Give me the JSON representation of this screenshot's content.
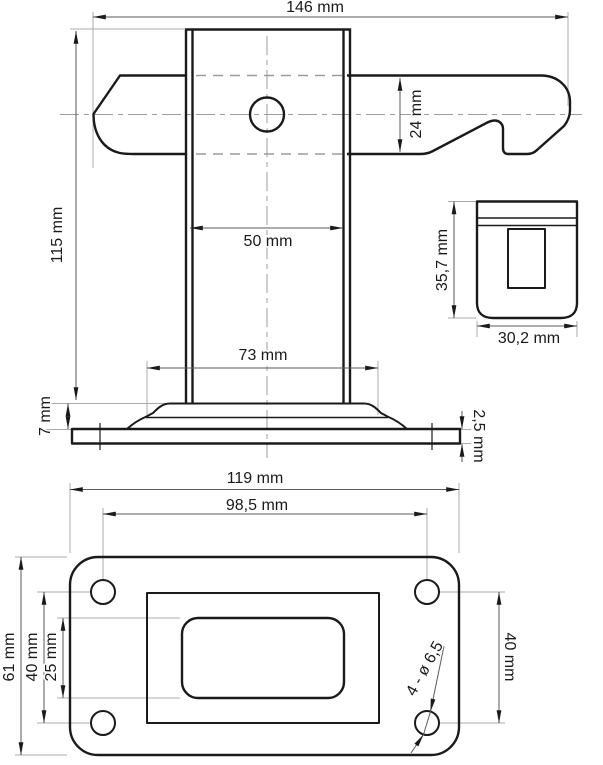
{
  "front_view": {
    "overall_width": "146 mm",
    "overall_height": "115 mm",
    "arm_height": "24 mm",
    "column_width": "50 mm",
    "base_width": "73 mm",
    "base_height": "7 mm",
    "base_plate_thickness": "2,5 mm"
  },
  "side_view": {
    "height": "35,7 mm",
    "width": "30,2 mm"
  },
  "bottom_view": {
    "overall_width": "119 mm",
    "hole_spacing_width": "98,5 mm",
    "overall_height": "61 mm",
    "hole_spacing_height_left": "40 mm",
    "slot_height": "25 mm",
    "hole_spacing_height_right": "40 mm",
    "hole_callout": "4 - ø 6,5"
  },
  "colors": {
    "bg": "#ffffff",
    "line": "#1a1a1a",
    "dim": "#5a5a5a",
    "ext": "#ababab",
    "center": "#9c9c9c",
    "hidden": "#9c9c9c"
  }
}
